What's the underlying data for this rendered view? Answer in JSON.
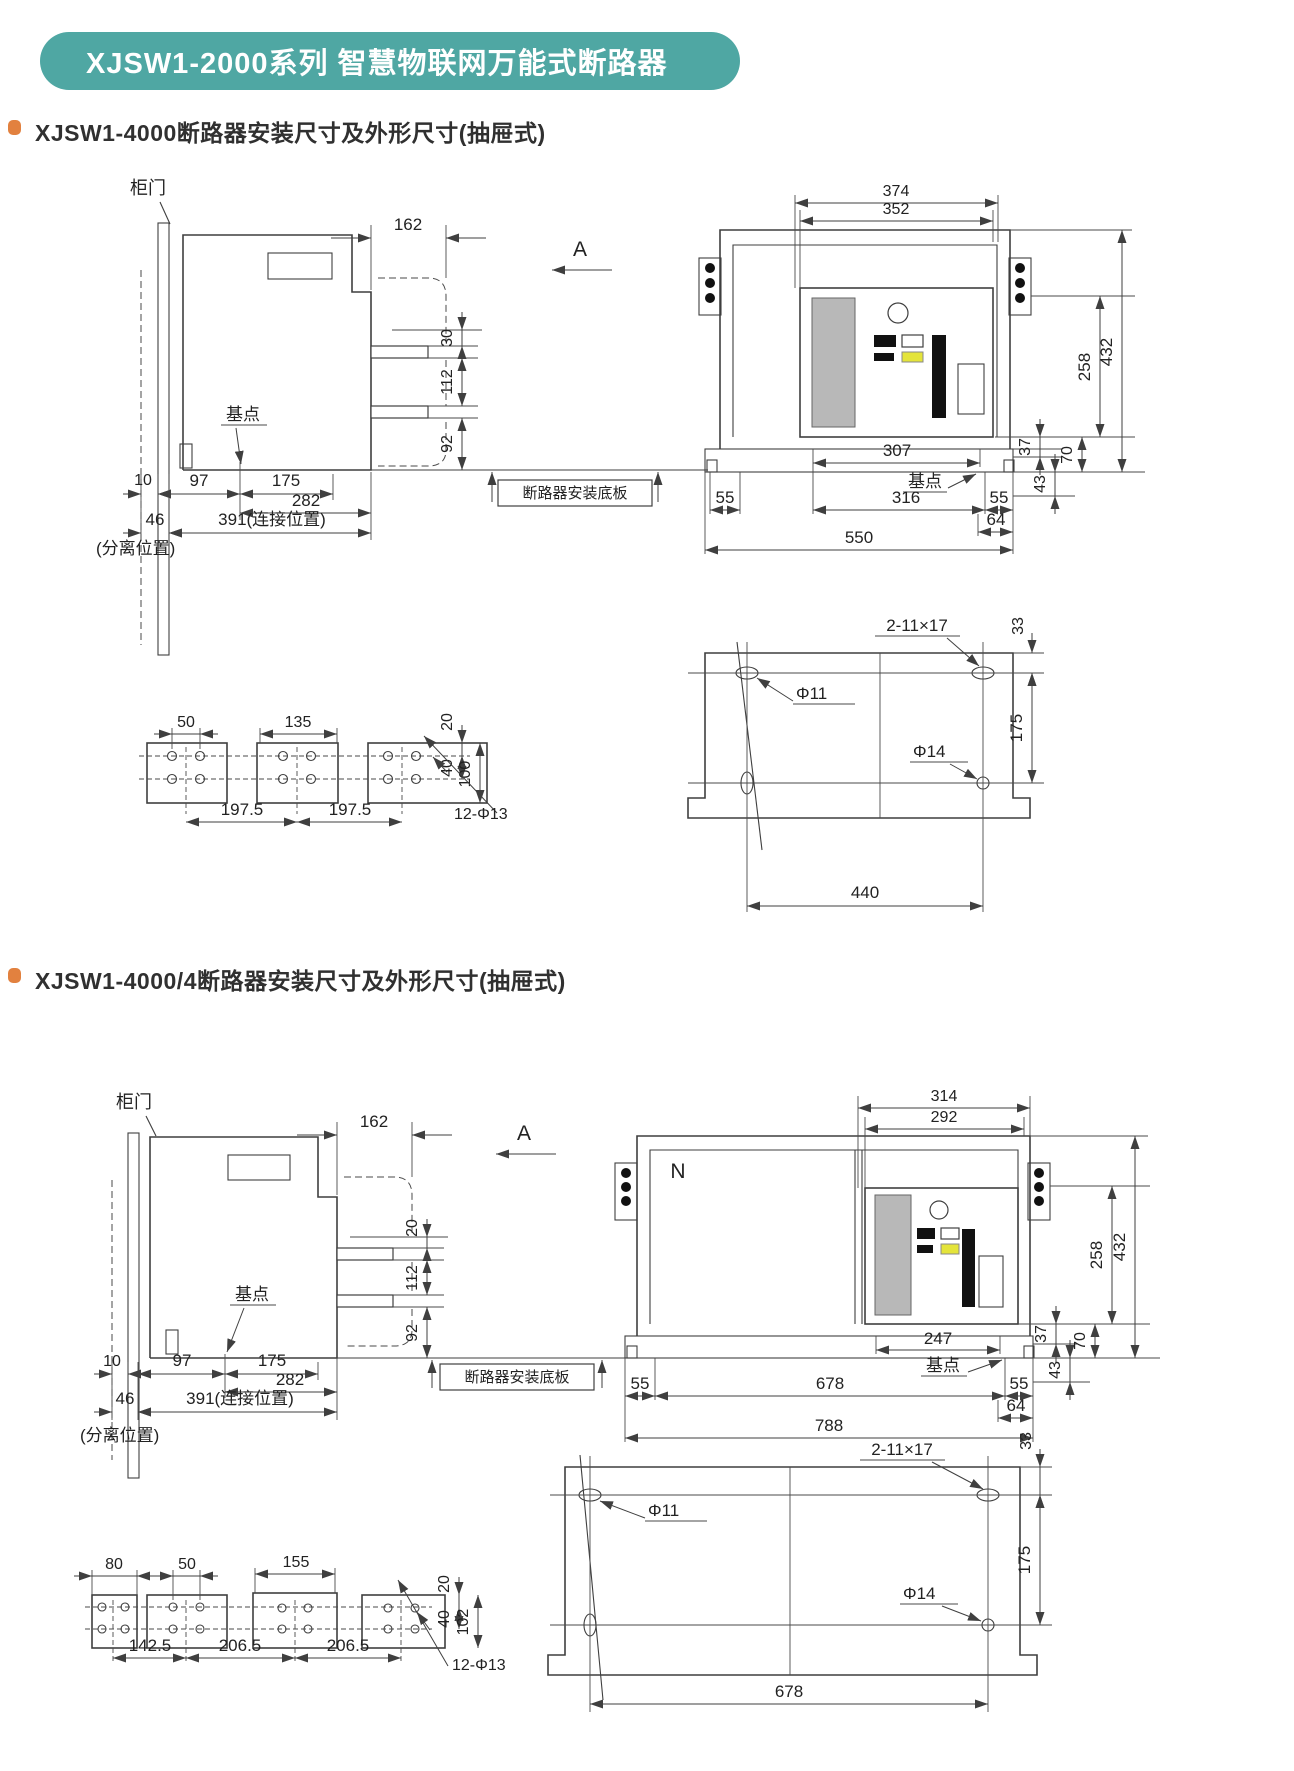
{
  "page": {
    "title": "XJSW1-2000系列 智慧物联网万能式断路器",
    "teal": "#4FA7A3",
    "orange": "#E2813F"
  },
  "s1": {
    "heading": "XJSW1-4000断路器安装尺寸及外形尺寸(抽屉式)",
    "side": {
      "door": "柜门",
      "base_point": "基点",
      "view_label": "A",
      "plate_label": "断路器安装底板",
      "d162": "162",
      "d30": "30",
      "d112": "112",
      "d92": "92",
      "d10": "10",
      "d97": "97",
      "d175": "175",
      "d282": "282",
      "d46": "46",
      "d391": "391(连接位置)",
      "separated": "(分离位置)"
    },
    "front": {
      "d374": "374",
      "d352": "352",
      "d258": "258",
      "d432": "432",
      "d307": "307",
      "base_point": "基点",
      "d316": "316",
      "d55l": "55",
      "d55r": "55",
      "d64": "64",
      "d550": "550",
      "d37": "37",
      "d43": "43",
      "d70": "70"
    },
    "plates": {
      "d50": "50",
      "d135": "135",
      "d20": "20",
      "d40": "40",
      "d100": "100",
      "d197a": "197.5",
      "d197b": "197.5",
      "holes": "12-Φ13"
    },
    "plan": {
      "slots": "2-11×17",
      "d33": "33",
      "phi11": "Φ11",
      "phi14": "Φ14",
      "d175": "175",
      "d440": "440"
    }
  },
  "s2": {
    "heading": "XJSW1-4000/4断路器安装尺寸及外形尺寸(抽屉式)",
    "side": {
      "door": "柜门",
      "base_point": "基点",
      "view_label": "A",
      "plate_label": "断路器安装底板",
      "d162": "162",
      "d20": "20",
      "d112": "112",
      "d92": "92",
      "d10": "10",
      "d97": "97",
      "d175": "175",
      "d282": "282",
      "d46": "46",
      "d391": "391(连接位置)",
      "separated": "(分离位置)"
    },
    "front": {
      "n_pole": "N",
      "d314": "314",
      "d292": "292",
      "d258": "258",
      "d432": "432",
      "d247": "247",
      "base_point": "基点",
      "d55l": "55",
      "d678": "678",
      "d55r": "55",
      "d64": "64",
      "d788": "788",
      "d37": "37",
      "d43": "43",
      "d70": "70"
    },
    "plates": {
      "d80": "80",
      "d50": "50",
      "d155": "155",
      "d20": "20",
      "d40": "40",
      "d102": "102",
      "d142": "142.5",
      "d206a": "206.5",
      "d206b": "206.5",
      "holes": "12-Φ13"
    },
    "plan": {
      "slots": "2-11×17",
      "d33": "33",
      "phi11": "Φ11",
      "phi14": "Φ14",
      "d175": "175",
      "d678": "678"
    }
  }
}
